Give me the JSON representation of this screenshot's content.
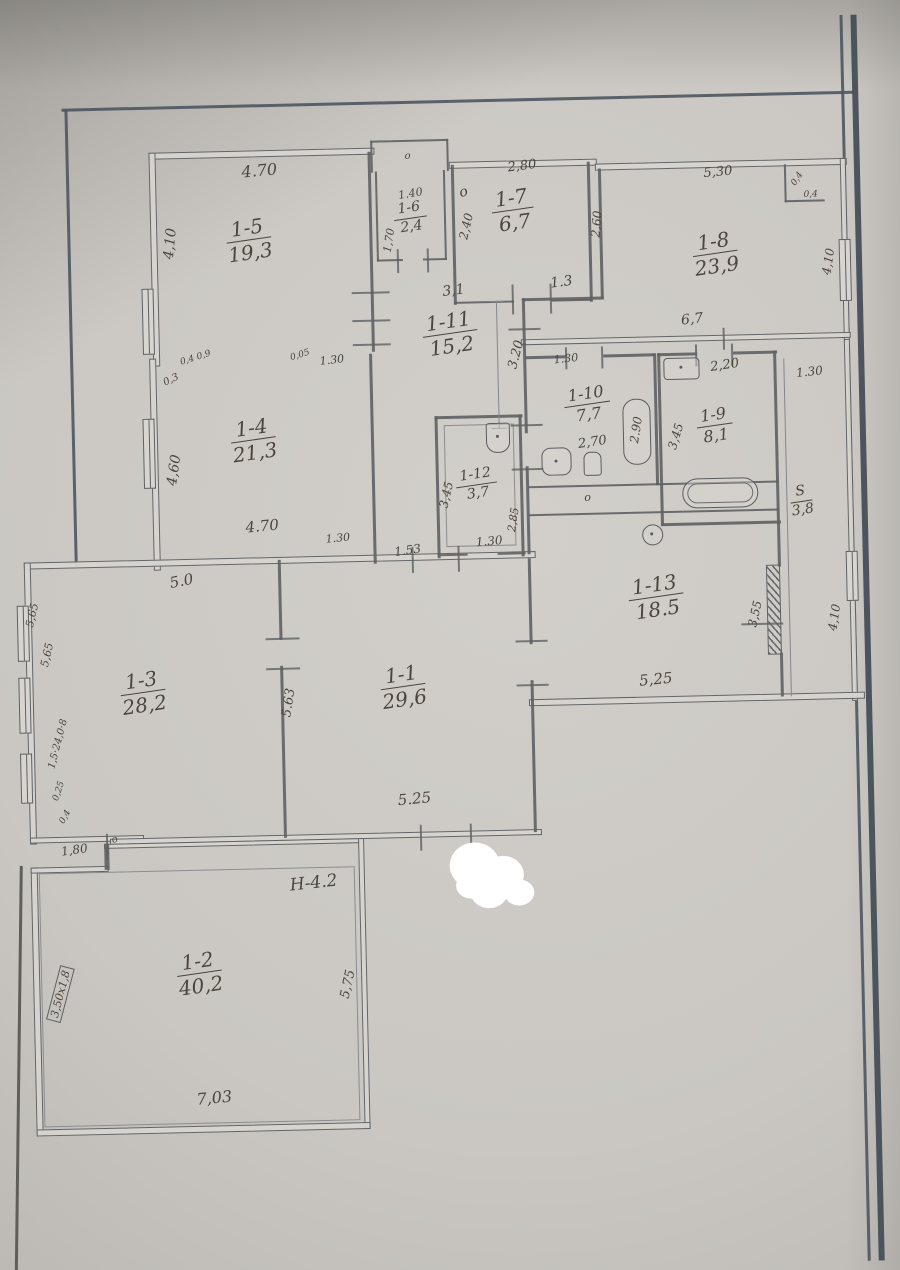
{
  "document": {
    "kind": "hand-drawn floor plan (scanned technical passport sheet)",
    "colors": {
      "paper": "#cac7c2",
      "ink": "#4a453d",
      "wall_line": "#5e6163",
      "frame_line": "#4c5560",
      "whiteout": "#ffffff"
    }
  },
  "plan": {
    "rooms": [
      {
        "id": "1-5",
        "area": "19,3"
      },
      {
        "id": "1-6",
        "area": "2,4"
      },
      {
        "id": "1-7",
        "area": "6,7"
      },
      {
        "id": "1-8",
        "area": "23,9"
      },
      {
        "id": "1-11",
        "area": "15,2"
      },
      {
        "id": "1-4",
        "area": "21,3"
      },
      {
        "id": "1-10",
        "area": "7,7"
      },
      {
        "id": "1-9",
        "area": "8,1"
      },
      {
        "id": "1-12",
        "area": "3,7"
      },
      {
        "id": "S",
        "area": "3,8"
      },
      {
        "id": "1-13",
        "area": "18.5"
      },
      {
        "id": "1-3",
        "area": "28,2"
      },
      {
        "id": "1-1",
        "area": "29,6"
      },
      {
        "id": "1-2",
        "area": "40,2"
      }
    ],
    "dims": [
      "4.70",
      "4,10",
      "1.40",
      "1,70",
      "2,80",
      "2,40",
      "2,60",
      "5,30",
      "0,4",
      "0,4",
      "4,10",
      "3,1",
      "1.3",
      "6,7",
      "3.20",
      "1.30",
      "0,3",
      "0,4 0,9",
      "0,05",
      "1.30",
      "4,60",
      "4.70",
      "1.30",
      "5.0",
      "1.53",
      "3,45",
      "2,85",
      "1.30",
      "2,70",
      "2.90",
      "2,20",
      "3,45",
      "1.30",
      "3,55",
      "4,10",
      "5,25",
      "5.63",
      "5.25",
      "1,80",
      "Н-4.2",
      "5,75",
      "7,03",
      "3,50х1,8",
      "5,65",
      "5,65",
      "1,5·24,0·8",
      "0,25",
      "0,4",
      "о",
      "о",
      "о",
      "о"
    ]
  }
}
